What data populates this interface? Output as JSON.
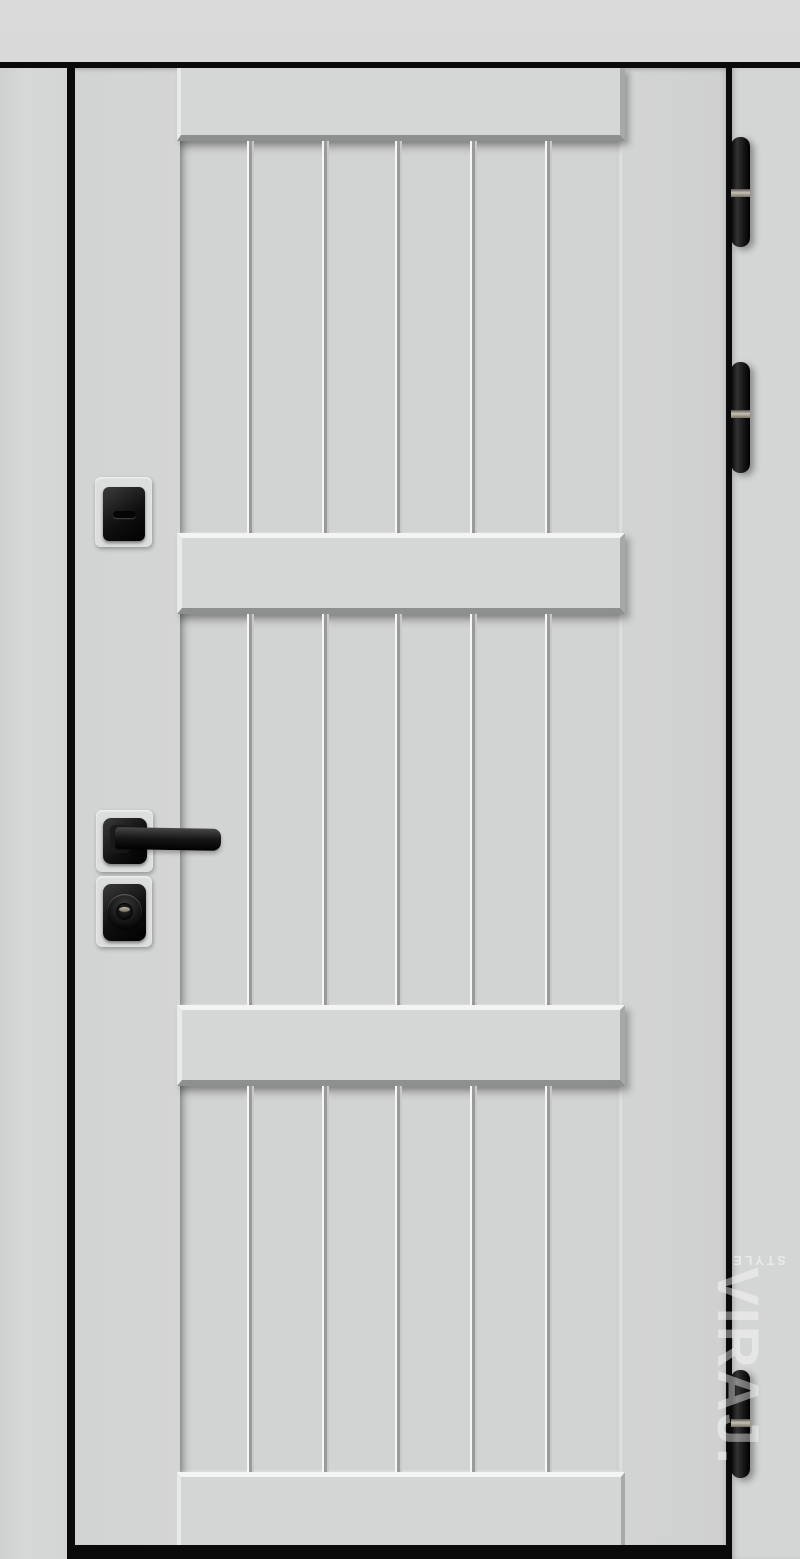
{
  "watermark": {
    "brand": "VIRAJ.",
    "sub": "STYLE"
  },
  "colors": {
    "wall": "#d8d8d8",
    "sidepanel": "#d4d5d5",
    "door": "#d3d4d4",
    "panel": "#d5d6d6",
    "frame": "#0a0a0a",
    "hardware": "#141414",
    "hinge_band": "#c6c1b4"
  },
  "door": {
    "finish": "matte light gray",
    "plank_count_per_section": 6,
    "plank_sections": 3,
    "rails": 4,
    "hinges": 3,
    "hardware_items": [
      "keyhole-cover",
      "lever-handle",
      "cylinder-lock"
    ]
  }
}
